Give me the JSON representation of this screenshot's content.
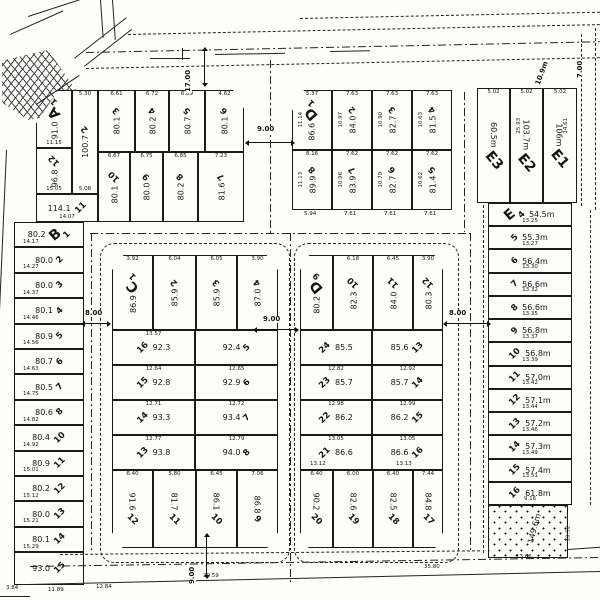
{
  "roads": {
    "top_width": "17.00",
    "top_street_width": "9.00",
    "right_top_width": "7.00",
    "corner_radius_label": "10.9m",
    "west_ring_width": "8.00",
    "center_street_width": "9.00",
    "east_ring_width": "8.00",
    "south_street_width": "9.00"
  },
  "boundary_dims": [
    "3.84",
    "11.89",
    "12.84",
    "29.59",
    "35.80"
  ],
  "block_a": {
    "letter": "A",
    "left_lots": [
      {
        "no": "1",
        "area": "91.0",
        "w": "3.14",
        "dim": "11.15"
      },
      {
        "no": "2",
        "area": "100.7",
        "w": "5.30",
        "dim": "5.08"
      },
      {
        "no": "12",
        "area": "96.8",
        "dim": "15.05"
      },
      {
        "no": "11",
        "area": "114.1",
        "dim": "14.07"
      }
    ],
    "top_row": [
      {
        "no": "3",
        "area": "80.1",
        "w": "6.61"
      },
      {
        "no": "4",
        "area": "80.2",
        "w": "6.72"
      },
      {
        "no": "5",
        "area": "80.7",
        "w": "6.89"
      },
      {
        "no": "6",
        "area": "80.1",
        "w": "4.62"
      }
    ],
    "bottom_row": [
      {
        "no": "10",
        "area": "80.1",
        "w": "6.67"
      },
      {
        "no": "9",
        "area": "80.0",
        "w": "6.75"
      },
      {
        "no": "8",
        "area": "80.2",
        "w": "6.85"
      },
      {
        "no": "7",
        "area": "81.6",
        "w": "7.23"
      }
    ]
  },
  "block_b": {
    "letter": "B",
    "lots": [
      {
        "no": "1",
        "area": "80.2",
        "dim": "14.17"
      },
      {
        "no": "2",
        "area": "80.0",
        "dim": "14.27"
      },
      {
        "no": "3",
        "area": "80.0",
        "dim": "14.37"
      },
      {
        "no": "4",
        "area": "80.1",
        "dim": "14.46"
      },
      {
        "no": "5",
        "area": "80.9",
        "dim": "14.56"
      },
      {
        "no": "6",
        "area": "80.7",
        "dim": "14.63"
      },
      {
        "no": "7",
        "area": "80.5",
        "dim": "14.75"
      },
      {
        "no": "8",
        "area": "80.6",
        "dim": "14.82"
      },
      {
        "no": "10",
        "area": "80.4",
        "dim": "14.92"
      },
      {
        "no": "11",
        "area": "80.9",
        "dim": "15.01"
      },
      {
        "no": "12",
        "area": "80.2",
        "dim": "15.12"
      },
      {
        "no": "13",
        "area": "80.0",
        "dim": "15.21"
      },
      {
        "no": "14",
        "area": "80.1",
        "dim": "15.29"
      },
      {
        "no": "15",
        "area": "93.0",
        "dim": ""
      }
    ]
  },
  "block_c": {
    "letter": "C",
    "top_row": [
      {
        "no": "1",
        "area": "86.9",
        "w": "3.92"
      },
      {
        "no": "2",
        "area": "85.9",
        "w": "6.04"
      },
      {
        "no": "3",
        "area": "85.9",
        "w": "6.05"
      },
      {
        "no": "4",
        "area": "87.0",
        "w": "3.90"
      }
    ],
    "mid_rows": [
      {
        "l_no": "16",
        "l_area": "92.3",
        "l_dim": "13.57",
        "r_no": "5",
        "r_area": "92.4",
        "r_dim": ""
      },
      {
        "l_no": "15",
        "l_area": "92.8",
        "l_dim": "12.64",
        "r_no": "6",
        "r_area": "92.9",
        "r_dim": "12.65"
      },
      {
        "l_no": "14",
        "l_area": "93.3",
        "l_dim": "12.71",
        "r_no": "7",
        "r_area": "93.4",
        "r_dim": "12.72"
      },
      {
        "l_no": "13",
        "l_area": "93.8",
        "l_dim": "12.77",
        "r_no": "8",
        "r_area": "94.0",
        "r_dim": "12.79"
      }
    ],
    "bottom_row": [
      {
        "no": "12",
        "area": "91.6",
        "w": "6.40"
      },
      {
        "no": "11",
        "area": "81.7",
        "w": "5.80"
      },
      {
        "no": "10",
        "area": "86.1",
        "w": "6.45"
      },
      {
        "no": "9",
        "area": "86.8",
        "w": "7.06"
      }
    ]
  },
  "block_d": {
    "letter": "D",
    "top_row": [
      {
        "no": "9",
        "area": "80.2",
        "w": ""
      },
      {
        "no": "10",
        "area": "82.3",
        "w": "6.18"
      },
      {
        "no": "11",
        "area": "84.0",
        "w": "6.45"
      },
      {
        "no": "12",
        "area": "80.3",
        "w": "3.90"
      }
    ],
    "mid_rows": [
      {
        "l_no": "24",
        "l_area": "85.5",
        "l_dim": "",
        "r_no": "13",
        "r_area": "85.6",
        "r_dim": ""
      },
      {
        "l_no": "23",
        "l_area": "85.7",
        "l_dim": "12.82",
        "r_no": "14",
        "r_area": "85.7",
        "r_dim": "12.92"
      },
      {
        "l_no": "22",
        "l_area": "86.2",
        "l_dim": "12.98",
        "r_no": "15",
        "r_area": "86.2",
        "r_dim": "12.99"
      },
      {
        "l_no": "21",
        "l_area": "86.6",
        "l_dim": "13.05",
        "r_no": "16",
        "r_area": "86.6",
        "r_dim": "13.05"
      }
    ],
    "row5_dims": [
      "13.12",
      "13.13"
    ],
    "bottom_row": [
      {
        "no": "20",
        "area": "90.2",
        "w": "6.40"
      },
      {
        "no": "19",
        "area": "82.6",
        "w": "6.00"
      },
      {
        "no": "18",
        "area": "82.5",
        "w": "6.40"
      },
      {
        "no": "17",
        "area": "84.8",
        "w": "7.44"
      }
    ]
  },
  "block_d_top": {
    "letter": "D",
    "top_row": [
      {
        "no": "1",
        "area": "86.6",
        "w": "5.37",
        "side": "11.14"
      },
      {
        "no": "2",
        "area": "84.0",
        "w": "7.63",
        "side": "10.97"
      },
      {
        "no": "3",
        "area": "82.7",
        "w": "7.63",
        "side": "10.90"
      },
      {
        "no": "4",
        "area": "81.5",
        "w": "7.63",
        "side": "10.63"
      }
    ],
    "bottom_row": [
      {
        "no": "8",
        "area": "89.9",
        "w": "8.16",
        "side": "11.13"
      },
      {
        "no": "7",
        "area": "83.9",
        "w": "7.62",
        "side": "10.96"
      },
      {
        "no": "6",
        "area": "82.7",
        "w": "7.62",
        "side": "10.79"
      },
      {
        "no": "5",
        "area": "81.4",
        "w": "7.62",
        "side": "10.62"
      }
    ],
    "bottom_dims": [
      "5.94",
      "7.61",
      "7.61",
      "7.61"
    ]
  },
  "block_e_strip": {
    "cols": [
      {
        "label": "E3",
        "area": "60.5m",
        "w": "5.02",
        "side": ""
      },
      {
        "label": "E2",
        "area": "103.7m",
        "w": "5.02",
        "side": "25.93"
      },
      {
        "label": "E1",
        "area": "106m",
        "w": "5.02",
        "side": "14.61"
      }
    ]
  },
  "block_e": {
    "letter": "E",
    "lots": [
      {
        "no": "4",
        "area": "54.5m",
        "dim": "13.25"
      },
      {
        "no": "5",
        "area": "55.3m",
        "dim": "13.27"
      },
      {
        "no": "6",
        "area": "56.4m",
        "dim": "13.30"
      },
      {
        "no": "7",
        "area": "56.6m",
        "dim": "13.32"
      },
      {
        "no": "8",
        "area": "56.6m",
        "dim": "13.35"
      },
      {
        "no": "9",
        "area": "56.8m",
        "dim": "13.37"
      },
      {
        "no": "10",
        "area": "56.8m",
        "dim": "13.39"
      },
      {
        "no": "11",
        "area": "57.0m",
        "dim": "13.42"
      },
      {
        "no": "12",
        "area": "57.1m",
        "dim": "13.44"
      },
      {
        "no": "13",
        "area": "57.2m",
        "dim": "13.46"
      },
      {
        "no": "14",
        "area": "57.3m",
        "dim": "13.49"
      },
      {
        "no": "15",
        "area": "57.4m",
        "dim": "13.51"
      },
      {
        "no": "16",
        "area": "61.8m",
        "dim": "9.16"
      }
    ]
  },
  "reserve": {
    "area": "149.6m",
    "dim_bottom": "13.66",
    "dim_right": "10.92"
  }
}
